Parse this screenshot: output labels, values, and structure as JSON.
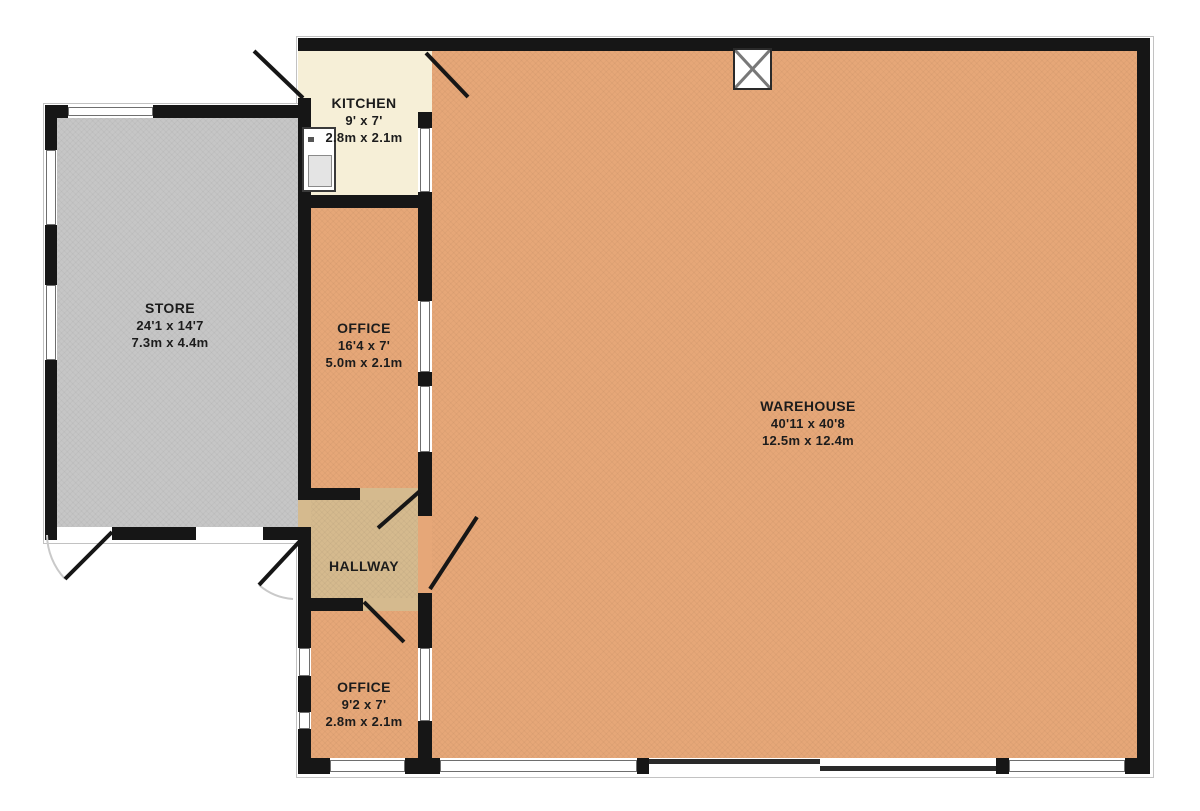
{
  "document": {
    "type": "commercial floor plan"
  },
  "rooms": {
    "store": {
      "name": "STORE",
      "size_imperial": "24'1 x 14'7",
      "size_metric": "7.3m x 4.4m"
    },
    "kitchen": {
      "name": "KITCHEN",
      "size_imperial": "9' x 7'",
      "size_metric": "2.8m x 2.1m"
    },
    "office_top": {
      "name": "OFFICE",
      "size_imperial": "16'4 x 7'",
      "size_metric": "5.0m x 2.1m"
    },
    "hallway": {
      "name": "HALLWAY"
    },
    "office_bottom": {
      "name": "OFFICE",
      "size_imperial": "9'2 x 7'",
      "size_metric": "2.8m x 2.1m"
    },
    "warehouse": {
      "name": "WAREHOUSE",
      "size_imperial": "40'11 x 40'8",
      "size_metric": "12.5m x 12.4m"
    }
  },
  "colors": {
    "floor_main": "#e6a778",
    "floor_kitchen": "#f6efd7",
    "floor_hallway": "#d5ba8e",
    "floor_store": "#c6c6c6",
    "wall": "#161616",
    "background": "#ffffff"
  },
  "symbols": {
    "roof_vent": "crossed square (vent / rooflight)",
    "sink": "kitchen sink unit",
    "doors": "hinged door leaves with swing arcs",
    "sliding_door": "offset thin panels on warehouse south wall"
  }
}
